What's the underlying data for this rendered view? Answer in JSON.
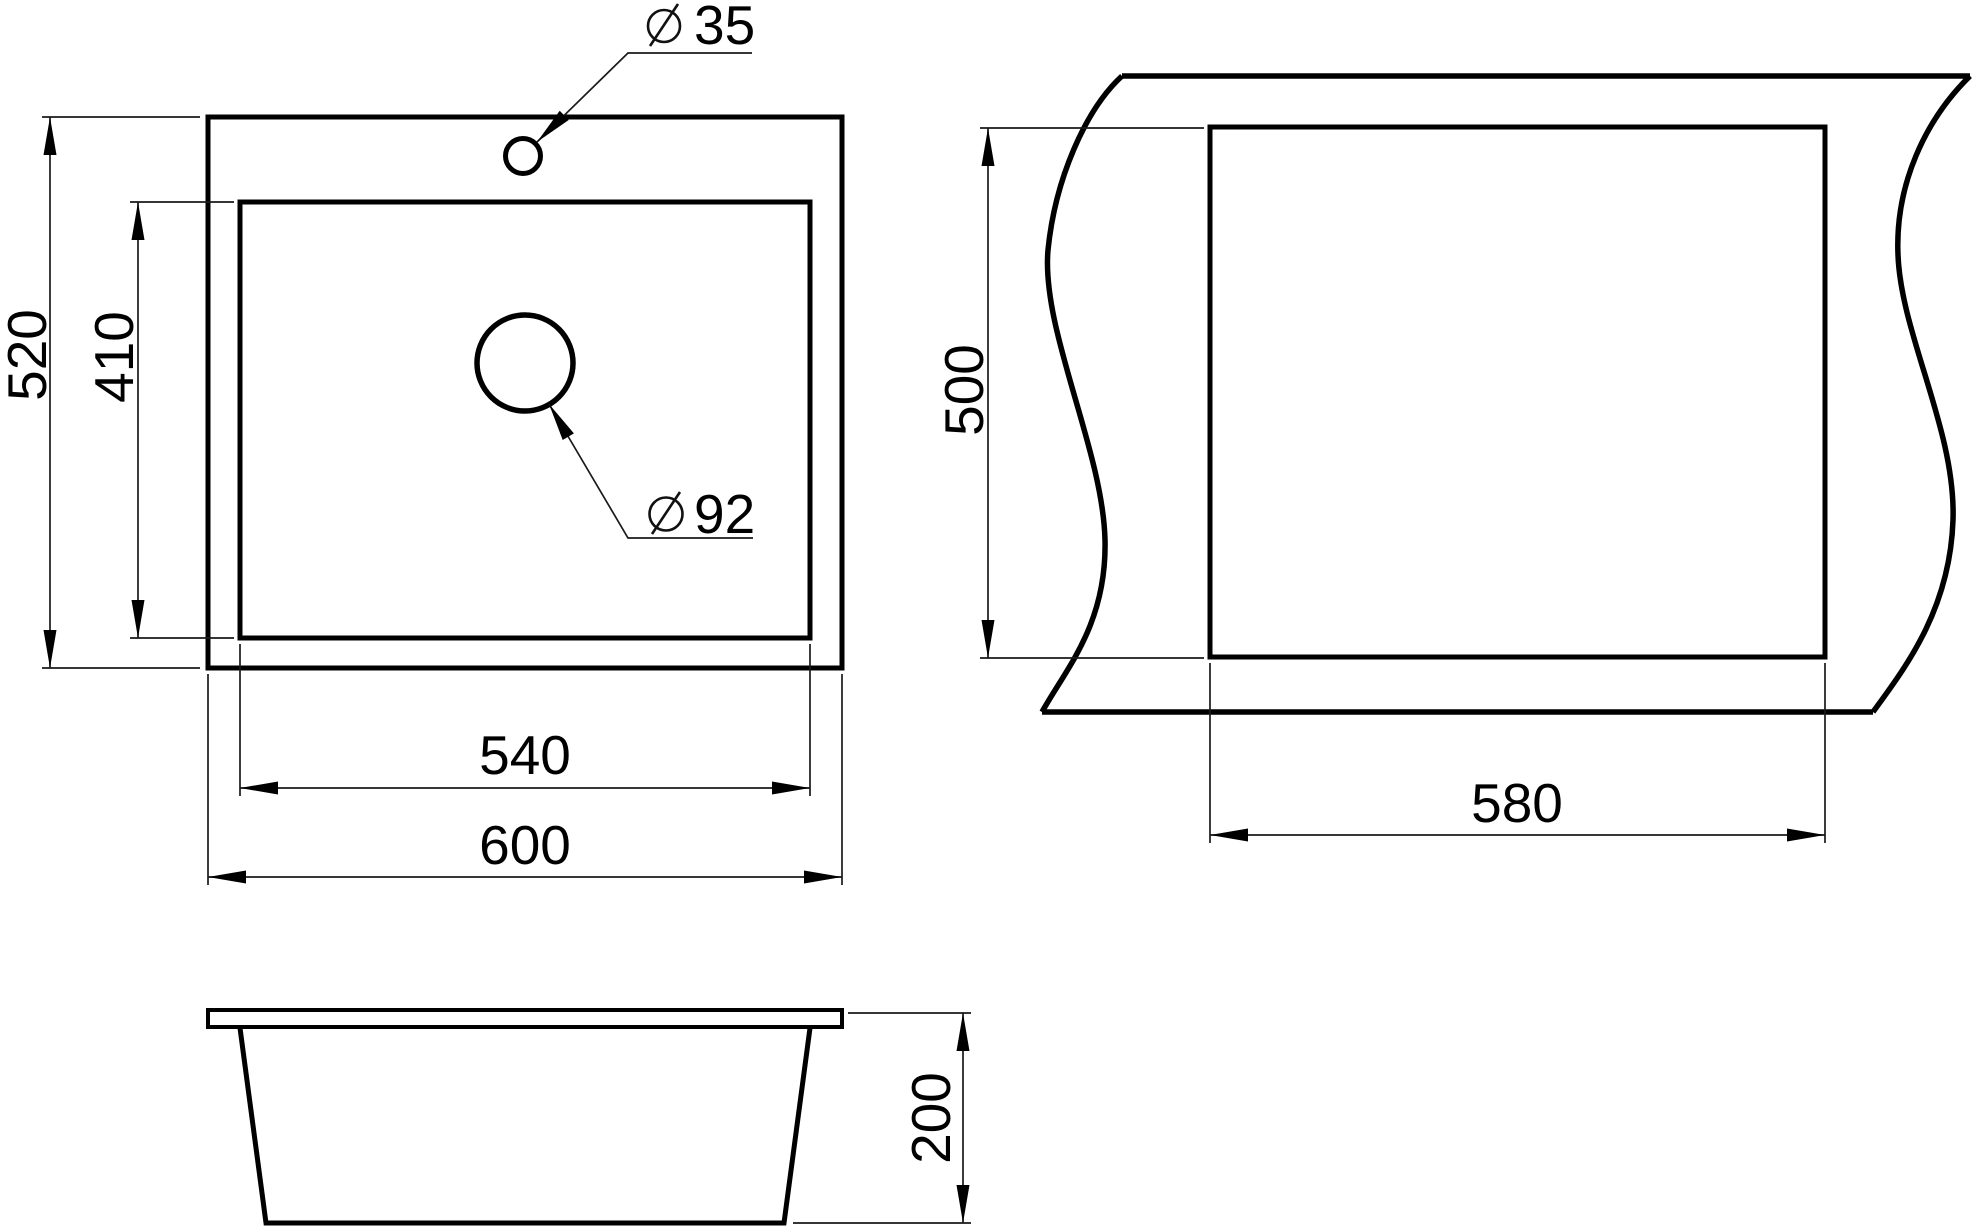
{
  "drawing": {
    "type": "technical-dimension-drawing",
    "subject": "kitchen sink with countertop cutout",
    "background": "#ffffff",
    "line_color": "#000000",
    "diameter_symbol": "⌀",
    "views": {
      "top": {
        "name": "top view",
        "dims": {
          "outer_height": "520",
          "bowl_height": "410",
          "bowl_width": "540",
          "outer_width": "600",
          "faucet_hole_dia": "35",
          "drain_hole_dia": "92"
        }
      },
      "cutout": {
        "name": "countertop cutout view",
        "dims": {
          "height": "500",
          "width": "580"
        }
      },
      "side": {
        "name": "side elevation view",
        "dims": {
          "depth": "200"
        }
      }
    }
  }
}
